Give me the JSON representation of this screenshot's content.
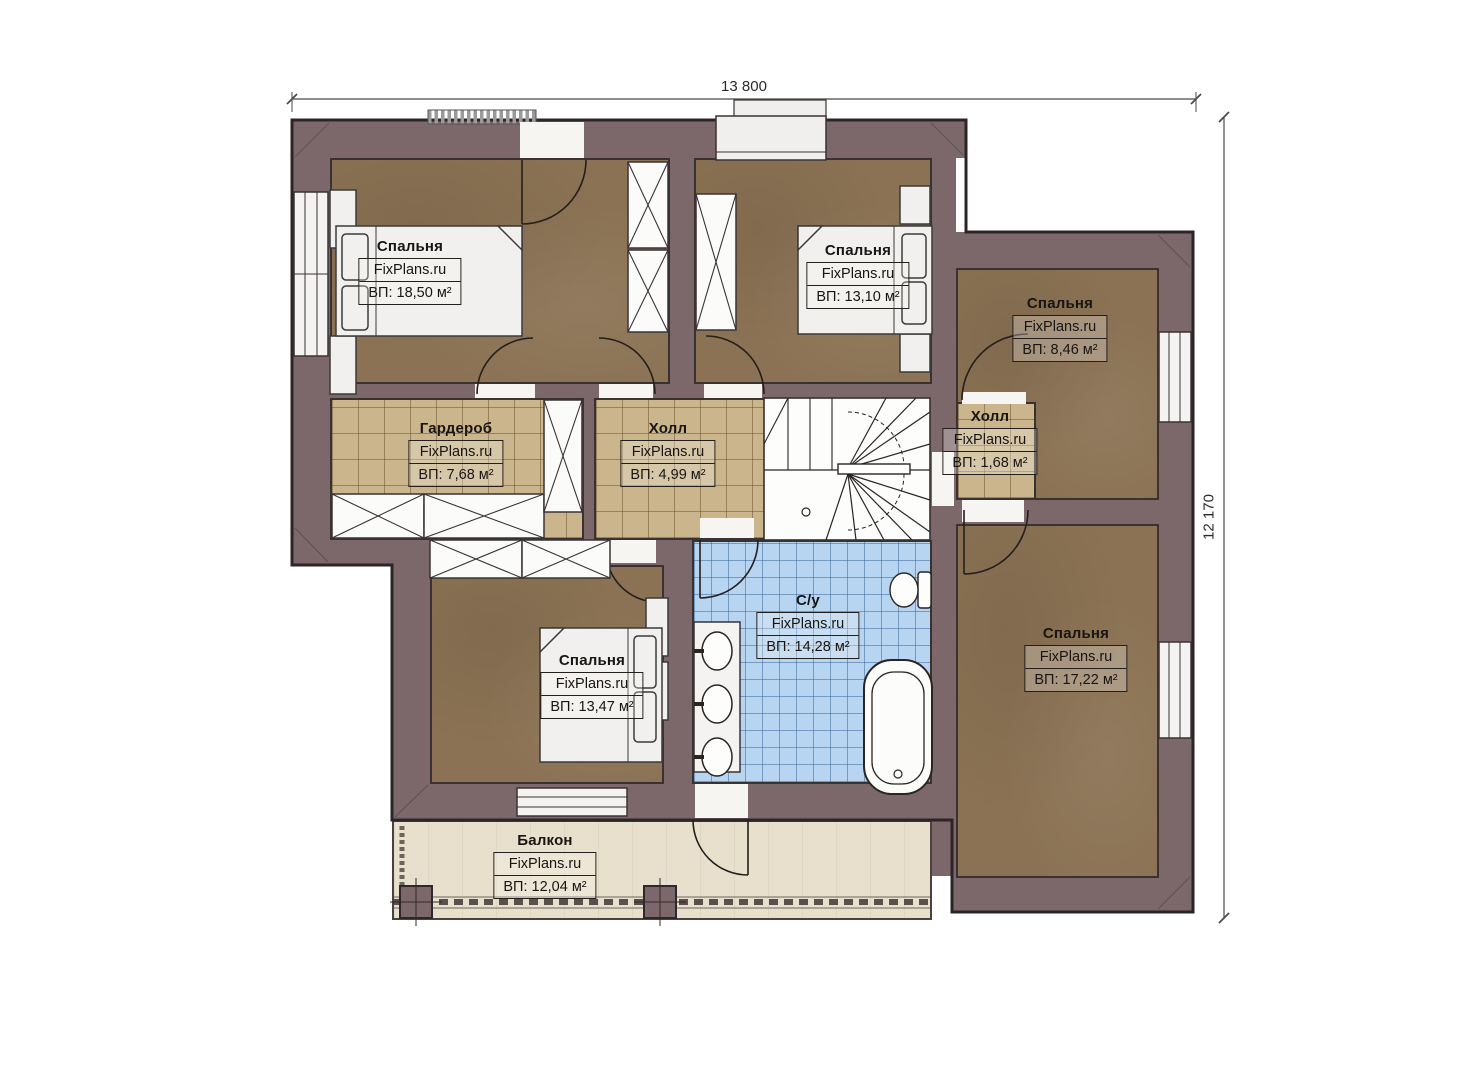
{
  "title": "Floor plan — second storey",
  "dimensions": {
    "width_label": "13 800",
    "height_label": "12 170"
  },
  "rooms": [
    {
      "id": "bedroom-top-left",
      "name": "Спальня",
      "brand": "FixPlans.ru",
      "area": "ВП: 18,50 м²"
    },
    {
      "id": "bedroom-top-middle",
      "name": "Спальня",
      "brand": "FixPlans.ru",
      "area": "ВП: 13,10 м²"
    },
    {
      "id": "bedroom-top-right",
      "name": "Спальня",
      "brand": "FixPlans.ru",
      "area": "ВП: 8,46 м²"
    },
    {
      "id": "wardrobe",
      "name": "Гардероб",
      "brand": "FixPlans.ru",
      "area": "ВП: 7,68 м²"
    },
    {
      "id": "hall-main",
      "name": "Холл",
      "brand": "FixPlans.ru",
      "area": "ВП: 4,99 м²"
    },
    {
      "id": "hall-small",
      "name": "Холл",
      "brand": "FixPlans.ru",
      "area": "ВП: 1,68 м²"
    },
    {
      "id": "bedroom-bottom-left",
      "name": "Спальня",
      "brand": "FixPlans.ru",
      "area": "ВП: 13,47 м²"
    },
    {
      "id": "bathroom",
      "name": "С/у",
      "brand": "FixPlans.ru",
      "area": "ВП: 14,28 м²"
    },
    {
      "id": "bedroom-right",
      "name": "Спальня",
      "brand": "FixPlans.ru",
      "area": "ВП: 17,22 м²"
    },
    {
      "id": "balcony",
      "name": "Балкон",
      "brand": "FixPlans.ru",
      "area": "ВП: 12,04 м²"
    }
  ],
  "colors": {
    "wall": "#7c686b",
    "wood_floor": "#8b7254",
    "tile_floor": "#cab58d",
    "bath_floor": "#b7d5f0",
    "balcony_floor": "#e8dfcc",
    "outline": "#3a3231"
  }
}
